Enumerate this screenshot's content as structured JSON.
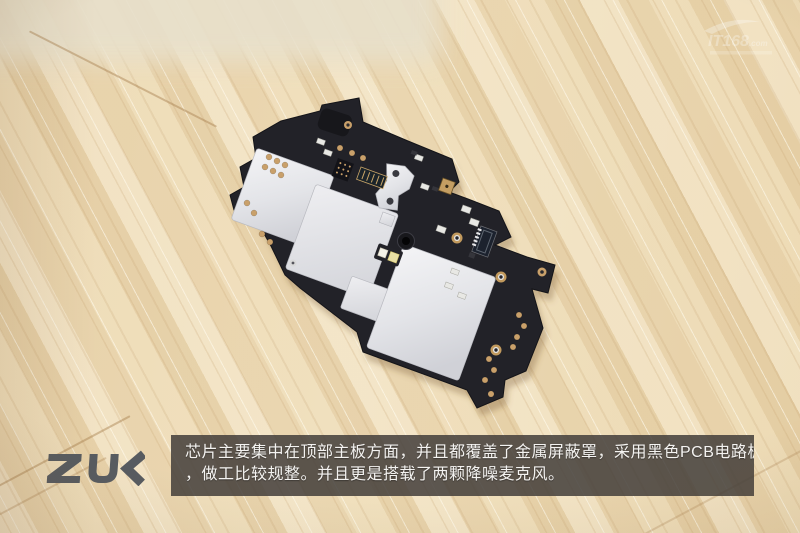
{
  "scene": {
    "description": "Teardown photo of a ZUK smartphone top main board lying diagonally on a light wooden table",
    "board": "black PCB with silver metal EMI shields, gold edge pads, connectors, dual LED flash and gold microphone"
  },
  "brand": {
    "logo_text": "ZUK"
  },
  "watermark": {
    "text": "IT168",
    "suffix": ".com"
  },
  "caption": {
    "line1": "芯片主要集中在顶部主板方面，并且都覆盖了金属屏蔽罩，采用黑色PCB电路板",
    "line2": "，做工比较规整。并且更是搭载了两颗降噪麦克风。"
  },
  "colors": {
    "pcb_black": "#222228",
    "shield_silver": "#e4e5e9",
    "gold_pad": "#c9a06a",
    "wood_light": "#f0e2c2",
    "wood_mid": "#e7d4ac",
    "caption_background": "rgba(66,61,57,0.85)",
    "logo_gray": "#575b60"
  }
}
